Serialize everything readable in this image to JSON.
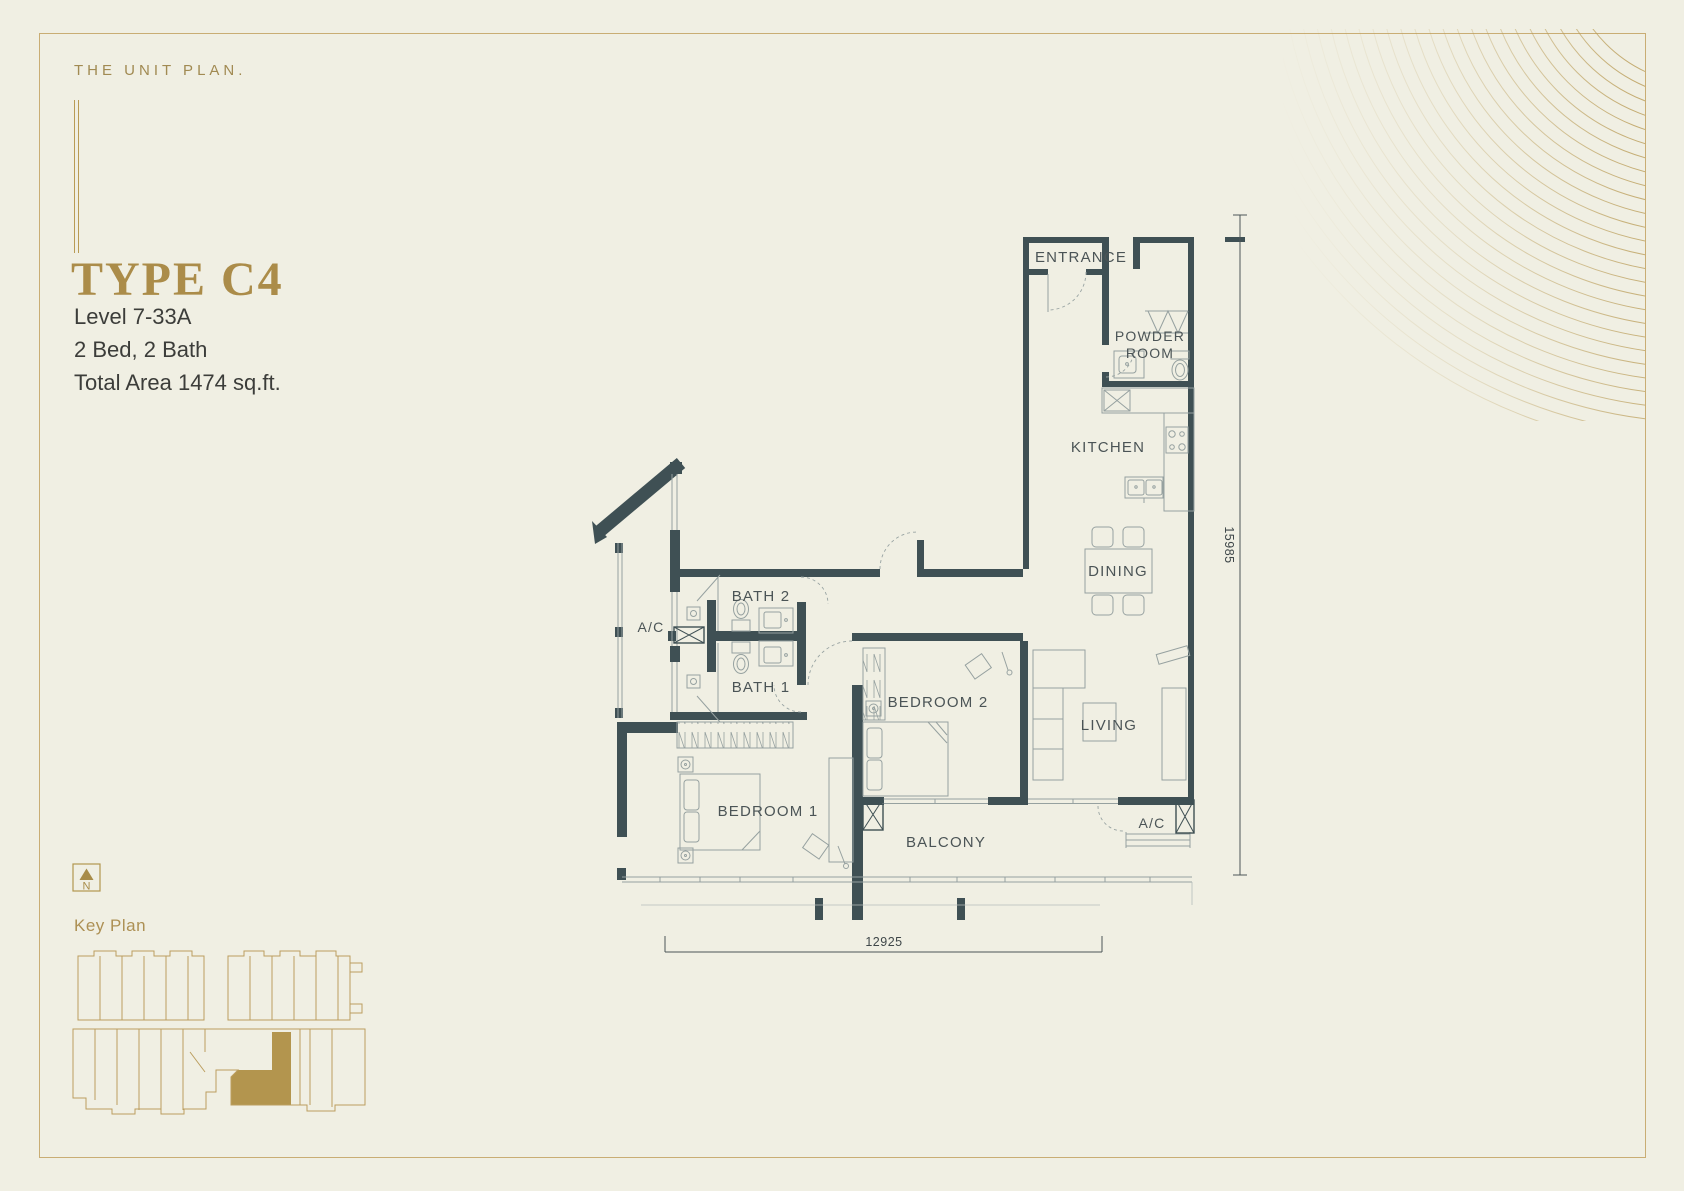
{
  "header": {
    "eyebrow": "THE UNIT PLAN.",
    "unit_type": "TYPE C4",
    "details": [
      "Level 7-33A",
      "2 Bed, 2 Bath",
      "Total Area 1474 sq.ft."
    ]
  },
  "plan": {
    "rooms": {
      "entrance": "ENTRANCE",
      "powder_room_line1": "POWDER",
      "powder_room_line2": "ROOM",
      "kitchen": "KITCHEN",
      "dining": "DINING",
      "living": "LIVING",
      "bath2": "BATH 2",
      "bath1": "BATH 1",
      "bedroom2": "BEDROOM 2",
      "bedroom1": "BEDROOM 1",
      "balcony": "BALCONY",
      "ac_side": "A/C",
      "ac_corner": "A/C"
    },
    "dimensions": {
      "vertical": "15985",
      "horizontal": "12925"
    }
  },
  "key_plan": {
    "label": "Key Plan",
    "north": "N"
  },
  "colors": {
    "background": "#f0efe3",
    "wall": "#3f5054",
    "gold_accent": "#ab8c49",
    "keyplan_gold": "#bb9e5f",
    "furniture_line": "#96a1a0",
    "text": "#3c3d3a"
  }
}
